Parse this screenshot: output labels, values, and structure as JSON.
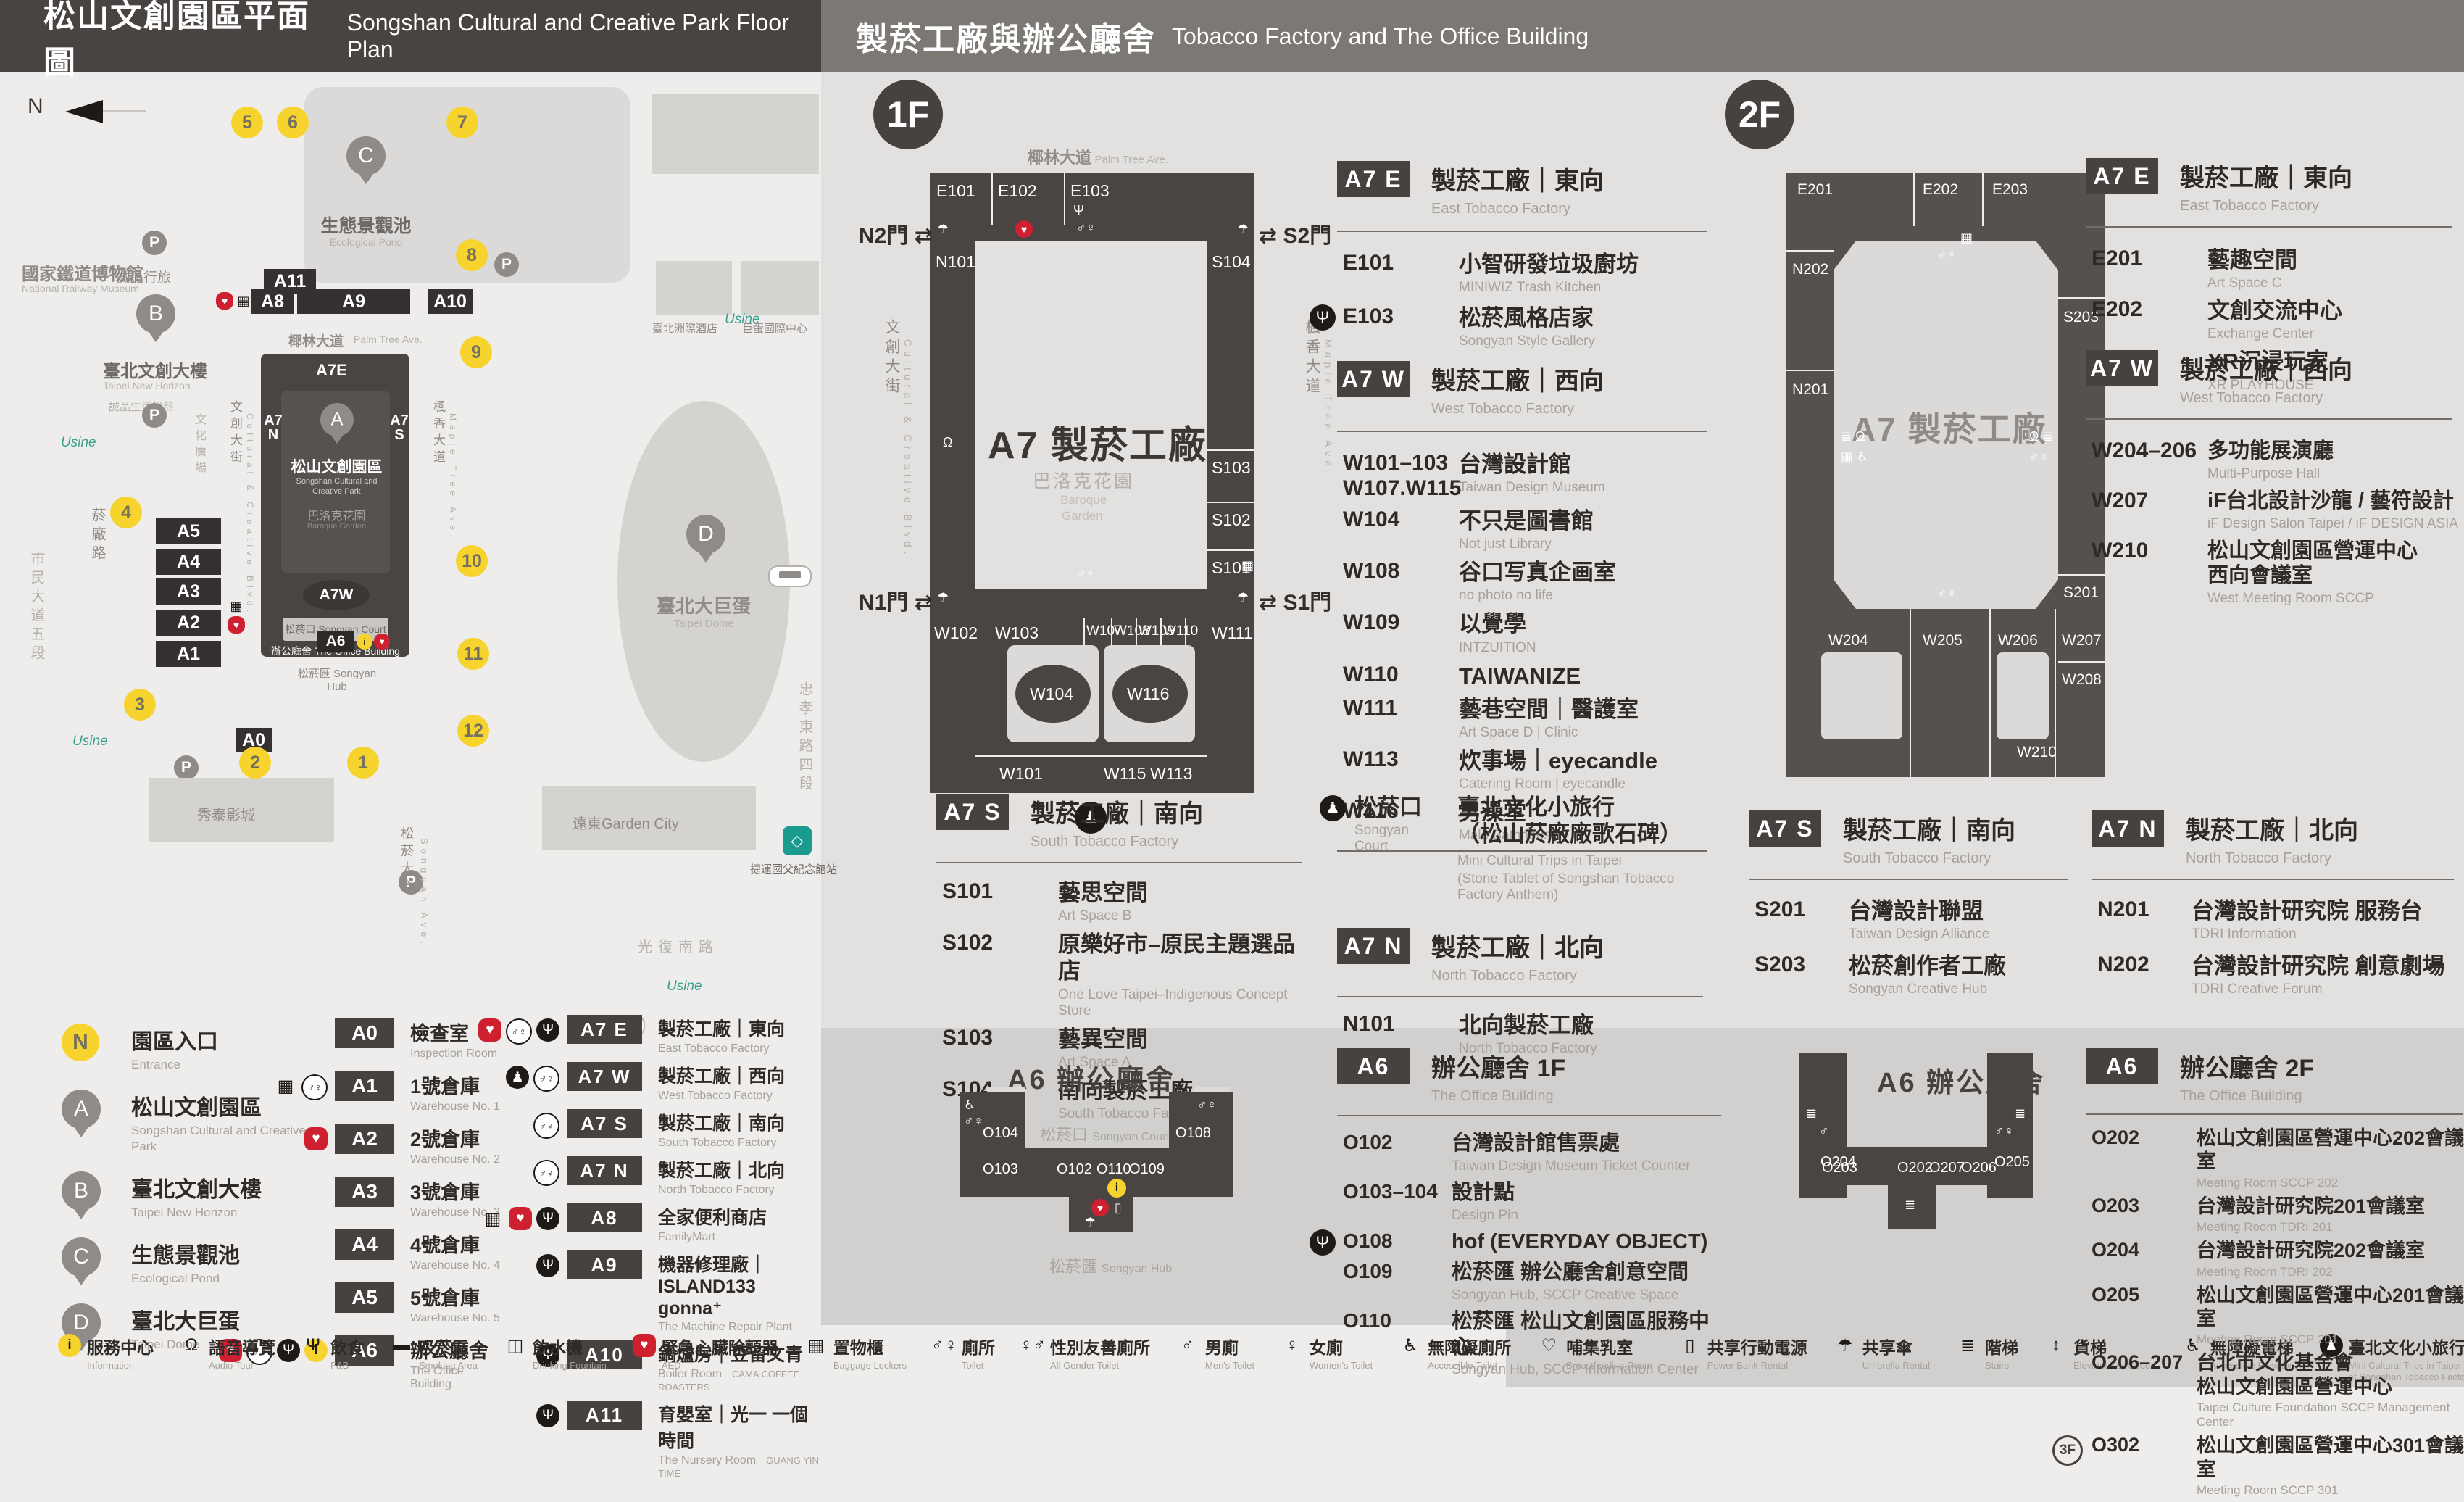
{
  "header": {
    "left_zh": "松山文創園區平面圖",
    "left_en": "Songshan Cultural and Creative Park Floor Plan",
    "right_zh": "製菸工廠與辦公廳舍",
    "right_en": "Tobacco Factory and The Office Building"
  },
  "colors": {
    "accent_yellow": "#f6d42d",
    "aed_red": "#cf2030",
    "building_dark": "#4a4442",
    "band_gray": "#d2d0ce"
  },
  "park": {
    "north": "N",
    "railway_zh": "國家鐵道博物館",
    "railway_en": "National Railway Museum",
    "pond_zh": "生態景觀池",
    "pond_en": "Ecological Pond",
    "eslite_hotel": "誠品行旅",
    "new_horizon_zh": "臺北文創大樓",
    "new_horizon_en": "Taipei New Horizon",
    "eslite_spectrum": "誠品生活松菸",
    "cultural_plaza_zh": "文化廣場",
    "cultural_plaza_en": "Cultural Plaza",
    "street_cultural_zh": "文創大街",
    "street_cultural_en": "Cultural & Creative Blvd.",
    "street_maple_zh": "楓香大道",
    "street_maple_en": "Maple Tree Ave.",
    "street_palm_zh": "椰林大道",
    "street_palm_en": "Palm Tree Ave.",
    "street_yanchang": "菸廠路",
    "street_civic": "市民大道五段",
    "street_guangfu": "光復南路",
    "street_zhongxiao": "忠孝東路四段",
    "street_songyan_zh": "松菸大道",
    "street_songyan_en": "Songyan Ave.",
    "sccp_zh": "松山文創園區",
    "sccp_en1": "Songshan Cultural and",
    "sccp_en2": "Creative Park",
    "baroque_zh": "巴洛克花園",
    "baroque_en": "Baroque Garden",
    "court_zh": "松菸口",
    "court_en": "Songyan Court",
    "office_zh": "辦公廳舍",
    "office_en": "The Office Building",
    "hub_zh": "松菸匯",
    "hub_en": "Songyan Hub",
    "dome_zh": "臺北大巨蛋",
    "dome_en": "Taipei Dome",
    "intercontinental": "臺北洲際酒店",
    "dome_center": "巨蛋國際中心",
    "gar_city": "遠東Garden City",
    "showtime": "秀泰影城",
    "mrt": "捷運國父紀念館站",
    "usine": "Usine",
    "a7e": "A7E",
    "a7w": "A7W",
    "a7n": "A7N",
    "a7s": "A7S",
    "pins": {
      "a": "A",
      "b": "B",
      "c": "C",
      "d": "D"
    },
    "boxes": {
      "a0": "A0",
      "a1": "A1",
      "a2": "A2",
      "a3": "A3",
      "a4": "A4",
      "a5": "A5",
      "a6": "A6",
      "a8": "A8",
      "a9": "A9",
      "a10": "A10",
      "a11": "A11"
    },
    "entrances": [
      "1",
      "2",
      "3",
      "4",
      "5",
      "6",
      "7",
      "8",
      "9",
      "10",
      "11",
      "12"
    ]
  },
  "legend": {
    "markers": [
      {
        "id": "N",
        "kind": "ent",
        "zh": "園區入口",
        "en": "Entrance"
      },
      {
        "id": "A",
        "kind": "pin",
        "zh": "松山文創園區",
        "en": "Songshan Cultural and Creative Park"
      },
      {
        "id": "B",
        "kind": "pin",
        "zh": "臺北文創大樓",
        "en": "Taipei New Horizon"
      },
      {
        "id": "C",
        "kind": "pin",
        "zh": "生態景觀池",
        "en": "Ecological Pond"
      },
      {
        "id": "D",
        "kind": "pin",
        "zh": "臺北大巨蛋",
        "en": "Taipei Dome"
      }
    ],
    "col_a": [
      {
        "code": "A0",
        "zh": "檢查室",
        "en": "Inspection Room",
        "icons": []
      },
      {
        "code": "A1",
        "zh": "1號倉庫",
        "en": "Warehouse No. 1",
        "icons": [
          {
            "k": "ic-plain",
            "g": "▦"
          },
          {
            "k": "ic-wht",
            "g": "♂♀"
          }
        ]
      },
      {
        "code": "A2",
        "zh": "2號倉庫",
        "en": "Warehouse No. 2",
        "icons": [
          {
            "k": "ic-aed",
            "g": "♥"
          }
        ]
      },
      {
        "code": "A3",
        "zh": "3號倉庫",
        "en": "Warehouse No. 3",
        "icons": []
      },
      {
        "code": "A4",
        "zh": "4號倉庫",
        "en": "Warehouse No. 4",
        "icons": []
      },
      {
        "code": "A5",
        "zh": "5號倉庫",
        "en": "Warehouse No. 5",
        "icons": []
      },
      {
        "code": "A6",
        "zh": "辦公廳舍",
        "en": "The Office Building",
        "icons": [
          {
            "k": "ic-aed",
            "g": "♥"
          },
          {
            "k": "ic-wht",
            "g": "♂♀"
          },
          {
            "k": "ic-blk",
            "g": "Ψ"
          },
          {
            "k": "ic-info",
            "g": "i"
          }
        ]
      }
    ],
    "col_b": [
      {
        "code": "A7 E",
        "zh": "製菸工廠｜東向",
        "en": "East Tobacco Factory",
        "icons": [
          {
            "k": "ic-aed",
            "g": "♥"
          },
          {
            "k": "ic-wht",
            "g": "♂♀"
          },
          {
            "k": "ic-blk",
            "g": "Ψ"
          }
        ]
      },
      {
        "code": "A7 W",
        "zh": "製菸工廠｜西向",
        "en": "West Tobacco Factory",
        "icons": [
          {
            "k": "ic-blk",
            "g": "♟"
          },
          {
            "k": "ic-wht",
            "g": "♂♀"
          }
        ]
      },
      {
        "code": "A7 S",
        "zh": "製菸工廠｜南向",
        "en": "South Tobacco Factory",
        "icons": [
          {
            "k": "ic-wht",
            "g": "♂♀"
          }
        ]
      },
      {
        "code": "A7 N",
        "zh": "製菸工廠｜北向",
        "en": "North Tobacco Factory",
        "icons": [
          {
            "k": "ic-wht",
            "g": "♂♀"
          }
        ]
      },
      {
        "code": "A8",
        "zh": "全家便利商店",
        "en": "FamilyMart",
        "icons": [
          {
            "k": "ic-plain",
            "g": "▦"
          },
          {
            "k": "ic-aed",
            "g": "♥"
          },
          {
            "k": "ic-blk",
            "g": "Ψ"
          }
        ]
      },
      {
        "code": "A9",
        "zh": "機器修理廠｜ISLAND133 gonna⁺",
        "en": "The Machine Repair Plant",
        "icons": [
          {
            "k": "ic-blk",
            "g": "Ψ"
          }
        ]
      },
      {
        "code": "A10",
        "zh": "鍋爐房｜豆留文青",
        "en": "Boiler Room",
        "en2": "CAMA COFFEE ROASTERS",
        "icons": [
          {
            "k": "ic-blk",
            "g": "Ψ"
          }
        ]
      },
      {
        "code": "A11",
        "zh": "育嬰室｜光一 一個時間",
        "en": "The Nursery Room",
        "en2": "GUANG YIN TIME",
        "icons": [
          {
            "k": "ic-blk",
            "g": "Ψ"
          }
        ]
      }
    ]
  },
  "floor1": {
    "badge": "1F",
    "map": {
      "street_top_zh": "椰林大道",
      "street_top_en": "Palm Tree Ave.",
      "street_left_zh": "文創大街",
      "street_left_en": "Cultural & Creative Blvd.",
      "street_right_zh": "楓香大道",
      "street_right_en": "Maple Tree Ave.",
      "gate_n2": "N2門",
      "gate_s2": "S2門",
      "gate_n1": "N1門",
      "gate_s1": "S1門",
      "big": "A7 製菸工廠",
      "garden_zh": "巴洛克花園",
      "garden_en1": "Baroque",
      "garden_en2": "Garden",
      "rooms": {
        "e101": "E101",
        "e102": "E102",
        "e103": "E103",
        "n101": "N101",
        "w102": "W102",
        "s104": "S104",
        "s103": "S103",
        "s102": "S102",
        "s101": "S101",
        "w103": "W103",
        "w107": "W107",
        "w108": "W108",
        "w109": "W109",
        "w110": "W110",
        "w111": "W111",
        "w104": "W104",
        "w116": "W116",
        "w101": "W101",
        "w115": "W115",
        "w113": "W113"
      }
    },
    "a7e": {
      "code": "A7 E",
      "zh": "製菸工廠｜東向",
      "en": "East Tobacco Factory",
      "rooms": [
        {
          "no": "E101",
          "zh": "小智研發垃圾廚坊",
          "en": "MINIWIZ Trash Kitchen"
        },
        {
          "no": "E103",
          "zh": "松菸風格店家",
          "en": "Songyan Style Gallery",
          "icon": "Ψ"
        }
      ]
    },
    "a7w": {
      "code": "A7 W",
      "zh": "製菸工廠｜西向",
      "en": "West Tobacco Factory",
      "rooms": [
        {
          "no": "W101–103\nW107.W115",
          "zh": "台灣設計館",
          "en": "Taiwan Design Museum"
        },
        {
          "no": "W104",
          "zh": "不只是圖書館",
          "en": "Not just Library"
        },
        {
          "no": "W108",
          "zh": "谷口写真企画室",
          "en": "no photo no life"
        },
        {
          "no": "W109",
          "zh": "以覺學",
          "en": "INTZUITION"
        },
        {
          "no": "W110",
          "zh": "TAIWANIZE"
        },
        {
          "no": "W111",
          "zh": "藝巷空間｜醫護室",
          "en": "Art Space D | Clinic"
        },
        {
          "no": "W113",
          "zh": "炊事場｜eyecandle",
          "en": "Catering Room | eyecandle"
        },
        {
          "no": "W116",
          "zh": "男澡堂",
          "en": "Male Bathhouse"
        }
      ]
    },
    "a7s": {
      "code": "A7 S",
      "zh": "製菸工廠｜南向",
      "en": "South Tobacco Factory",
      "rooms": [
        {
          "no": "S101",
          "zh": "藝思空間",
          "en": "Art Space B"
        },
        {
          "no": "S102",
          "zh": "原樂好市–原民主題選品店",
          "en": "One Love Taipei–Indigenous Concept Store"
        },
        {
          "no": "S103",
          "zh": "藝異空間",
          "en": "Art Space A"
        },
        {
          "no": "S104",
          "zh": "南向製菸工廠",
          "en": "South Tobacco Factory"
        }
      ]
    },
    "court": {
      "zh": "松菸口",
      "en": "Songyan Court",
      "t1": "臺北文化小旅行",
      "t2": "（松山菸廠廠歌石碑）",
      "e1": "Mini Cultural Trips in Taipei",
      "e2": "(Stone Tablet of Songshan Tobacco Factory Anthem)"
    },
    "a7n": {
      "code": "A7 N",
      "zh": "製菸工廠｜北向",
      "en": "North Tobacco Factory",
      "rooms": [
        {
          "no": "N101",
          "zh": "北向製菸工廠",
          "en": "North Tobacco Factory"
        }
      ]
    },
    "a6": {
      "code": "A6",
      "zh": "辦公廳舍 1F",
      "en": "The Office Building",
      "rooms": [
        {
          "no": "O102",
          "zh": "台灣設計館售票處",
          "en": "Taiwan Design Museum Ticket Counter"
        },
        {
          "no": "O103–104",
          "zh": "設計點",
          "en": "Design Pin"
        },
        {
          "no": "O108",
          "zh": "hof (EVERYDAY OBJECT)",
          "icon": "Ψ"
        },
        {
          "no": "O109",
          "zh": "松菸匯 辦公廳舍創意空間",
          "en": "Songyan Hub, SCCP Creative Space"
        },
        {
          "no": "O110",
          "zh": "松菸匯 松山文創園區服務中心",
          "en": "Songyan Hub, SCCP Information Center"
        }
      ]
    },
    "a6map": {
      "title": "A6 辦公廳舍",
      "court_zh": "松菸口",
      "court_en": "Songyan Court",
      "hub_zh": "松菸匯",
      "hub_en": "Songyan Hub",
      "rooms": {
        "o104": "O104",
        "o103": "O103",
        "o102": "O102",
        "o110": "O110",
        "o109": "O109",
        "o108": "O108"
      }
    }
  },
  "floor2": {
    "badge": "2F",
    "map": {
      "big": "A7 製菸工廠",
      "rooms": {
        "e201": "E201",
        "e202": "E202",
        "e203": "E203",
        "n202": "N202",
        "n201": "N201",
        "s203": "S203",
        "s201": "S201",
        "w204": "W204",
        "w205": "W205",
        "w206": "W206",
        "w207": "W207",
        "w208": "W208",
        "w210": "W210"
      }
    },
    "a7e": {
      "code": "A7 E",
      "zh": "製菸工廠｜東向",
      "en": "East Tobacco Factory",
      "rooms": [
        {
          "no": "E201",
          "zh": "藝趣空間",
          "en": "Art Space C"
        },
        {
          "no": "E202",
          "zh": "文創交流中心",
          "en": "Exchange Center"
        },
        {
          "no": "E203",
          "zh": "XR沉浸玩家",
          "en": "XR PLAYHOUSE"
        }
      ]
    },
    "a7w": {
      "code": "A7 W",
      "zh": "製菸工廠｜西向",
      "en": "West Tobacco Factory",
      "rooms": [
        {
          "no": "W204–206",
          "zh": "多功能展演廳",
          "en": "Multi-Purpose Hall"
        },
        {
          "no": "W207",
          "zh": "iF台北設計沙龍 / 藝符設計",
          "en": "iF Design Salon Taipei / iF DESIGN ASIA"
        },
        {
          "no": "W210",
          "zh": "松山文創園區營運中心\n西向會議室",
          "en": "West Meeting Room SCCP"
        }
      ]
    },
    "a7s": {
      "code": "A7 S",
      "zh": "製菸工廠｜南向",
      "en": "South Tobacco Factory",
      "rooms": [
        {
          "no": "S201",
          "zh": "台灣設計聯盟",
          "en": "Taiwan Design Alliance"
        },
        {
          "no": "S203",
          "zh": "松菸創作者工廠",
          "en": "Songyan Creative Hub"
        }
      ]
    },
    "a7n": {
      "code": "A7 N",
      "zh": "製菸工廠｜北向",
      "en": "North Tobacco Factory",
      "rooms": [
        {
          "no": "N201",
          "zh": "台灣設計研究院 服務台",
          "en": "TDRI Information"
        },
        {
          "no": "N202",
          "zh": "台灣設計研究院 創意劇場",
          "en": "TDRI Creative Forum"
        }
      ]
    },
    "a6": {
      "code": "A6",
      "zh": "辦公廳舍 2F",
      "en": "The Office Building",
      "rooms": [
        {
          "no": "O202",
          "zh": "松山文創園區營運中心202會議室",
          "en": "Meeting Room SCCP 202"
        },
        {
          "no": "O203",
          "zh": "台灣設計研究院201會議室",
          "en": "Meeting Room TDRI 201"
        },
        {
          "no": "O204",
          "zh": "台灣設計研究院202會議室",
          "en": "Meeting Room TDRI 202"
        },
        {
          "no": "O205",
          "zh": "松山文創園區營運中心201會議室",
          "en": "Meeting Room SCCP 201"
        },
        {
          "no": "O206–207",
          "zh": "台北市文化基金會\n松山文創園區營運中心",
          "en": "Taipei Culture Foundation SCCP Management Center"
        },
        {
          "no": "O302",
          "zh": "松山文創園區營運中心301會議室",
          "en": "Meeting Room SCCP 301",
          "badge": "3F"
        }
      ]
    },
    "a6map": {
      "title": "A6 辦公廳舍",
      "rooms": {
        "o204": "O204",
        "o203": "O203",
        "o202": "O202",
        "o207": "O207",
        "o206": "O206",
        "o205": "O205"
      }
    }
  },
  "facilities": [
    {
      "zh": "服務中心",
      "en": "Information",
      "k": "ic-info",
      "g": "i"
    },
    {
      "zh": "語音導覽",
      "en": "Audio Tour",
      "k": "ic-plain",
      "g": "Ω"
    },
    {
      "zh": "飲食",
      "en": "F&B",
      "k": "ic-plain",
      "g": "Ψ"
    },
    {
      "zh": "吸菸區",
      "en": "Smoking Area",
      "k": "ic-plain",
      "g": "▬"
    },
    {
      "zh": "飲水機",
      "en": "Drinking Fountain",
      "k": "ic-plain",
      "g": "◫"
    },
    {
      "zh": "緊急心臟除顫器",
      "en": "AED",
      "k": "ic-aed",
      "g": "♥"
    },
    {
      "zh": "置物櫃",
      "en": "Baggage Lockers",
      "k": "ic-plain",
      "g": "▦"
    },
    {
      "zh": "廁所",
      "en": "Toilet",
      "k": "ic-plain",
      "g": "♂♀"
    },
    {
      "zh": "性別友善廁所",
      "en": "All Gender Toilet",
      "k": "ic-plain",
      "g": "♀♂"
    },
    {
      "zh": "男廁",
      "en": "Men's Toilet",
      "k": "ic-plain",
      "g": "♂"
    },
    {
      "zh": "女廁",
      "en": "Women's Toilet",
      "k": "ic-plain",
      "g": "♀"
    },
    {
      "zh": "無障礙廁所",
      "en": "Accessible Toilet",
      "k": "ic-plain",
      "g": "♿"
    },
    {
      "zh": "哺集乳室",
      "en": "Breastfeeding Room",
      "k": "ic-plain",
      "g": "♡"
    },
    {
      "zh": "共享行動電源",
      "en": "Power Bank Rental",
      "k": "ic-plain",
      "g": "▯"
    },
    {
      "zh": "共享傘",
      "en": "Umbrella Rental",
      "k": "ic-plain",
      "g": "☂"
    },
    {
      "zh": "階梯",
      "en": "Stairs",
      "k": "ic-plain",
      "g": "≣"
    },
    {
      "zh": "貨梯",
      "en": "Elevator For Goods",
      "k": "ic-plain",
      "g": "↕"
    },
    {
      "zh": "無障礙電梯",
      "en": "Accessible Elevator",
      "k": "ic-plain",
      "g": "♿"
    },
    {
      "zh": "臺北文化小旅行",
      "zh2": "(松山菸廠廠歌石碑)",
      "en": "Mini Cultural Trips in Taipei (Stone Tablet of Songshan Tobacco Factory Anthem)",
      "k": "ic-blk",
      "g": "♟"
    }
  ]
}
